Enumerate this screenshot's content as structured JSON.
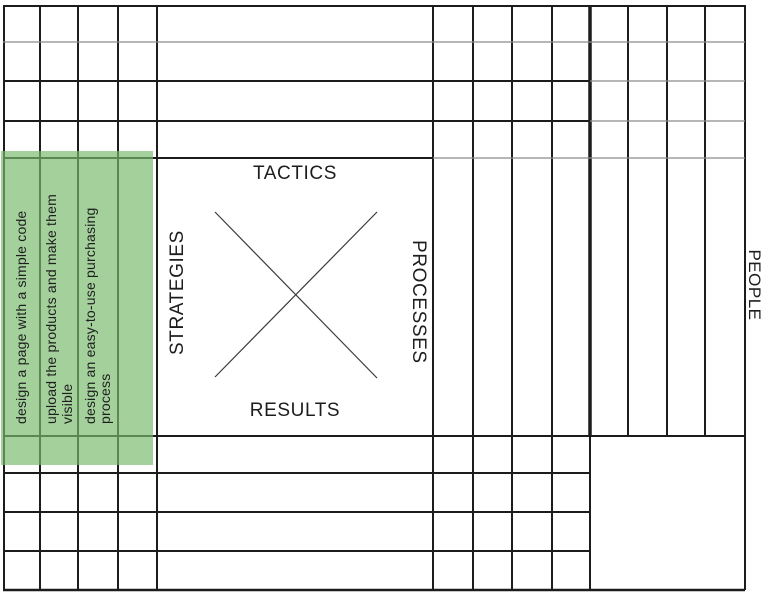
{
  "matrix": {
    "quadrant_labels": {
      "top": "TACTICS",
      "left": "STRATEGIES",
      "right": "PROCESSES",
      "bottom": "RESULTS",
      "side": "PEOPLE"
    },
    "strategies": [
      "design a page with a simple code",
      "upload the products and make them visible",
      "design an easy-to-use purchasing process"
    ],
    "colors": {
      "highlight_green": "#a9d4a1",
      "grid_line": "#1c1c1c",
      "grid_line_light": "#8a8a8a"
    }
  }
}
